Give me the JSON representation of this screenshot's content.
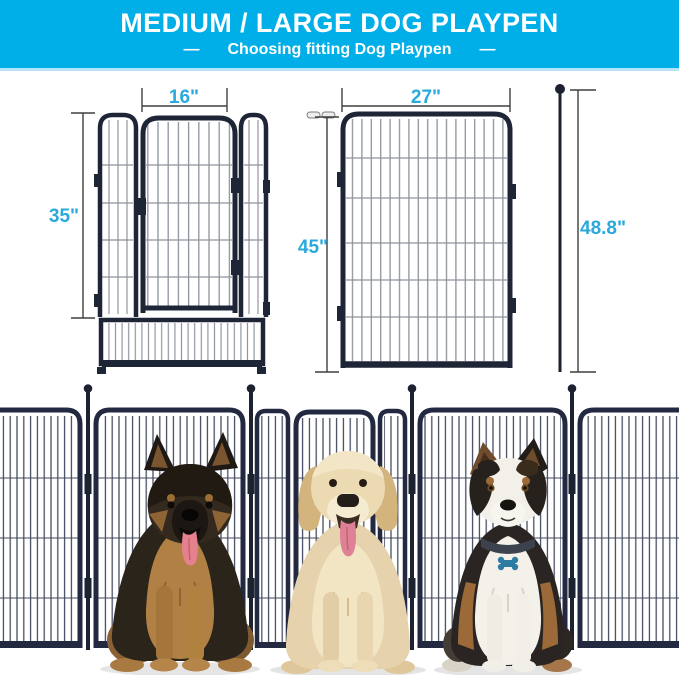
{
  "banner": {
    "title": "MEDIUM / LARGE DOG PLAYPEN",
    "dash_left": "—",
    "dash_right": "—",
    "subtitle": "Choosing fitting Dog Playpen",
    "bg_color": "#00AEE8",
    "text_color": "#FFFFFF"
  },
  "diagrams": {
    "accent_color": "#29A9DC",
    "line_color": "#3F3F3F",
    "frame_color": "#1E2536",
    "door_panel": {
      "door_width_label": "16\"",
      "height_label": "35\""
    },
    "standard_panel": {
      "width_label": "27\"",
      "height_label": "45\"",
      "overall_height_label": "48.8\""
    }
  },
  "photo": {
    "fence_color": "#222940",
    "tag_color": "#2D7CA4",
    "dogs": [
      {
        "name": "german-shepherd"
      },
      {
        "name": "golden-retriever"
      },
      {
        "name": "australian-shepherd"
      }
    ]
  }
}
